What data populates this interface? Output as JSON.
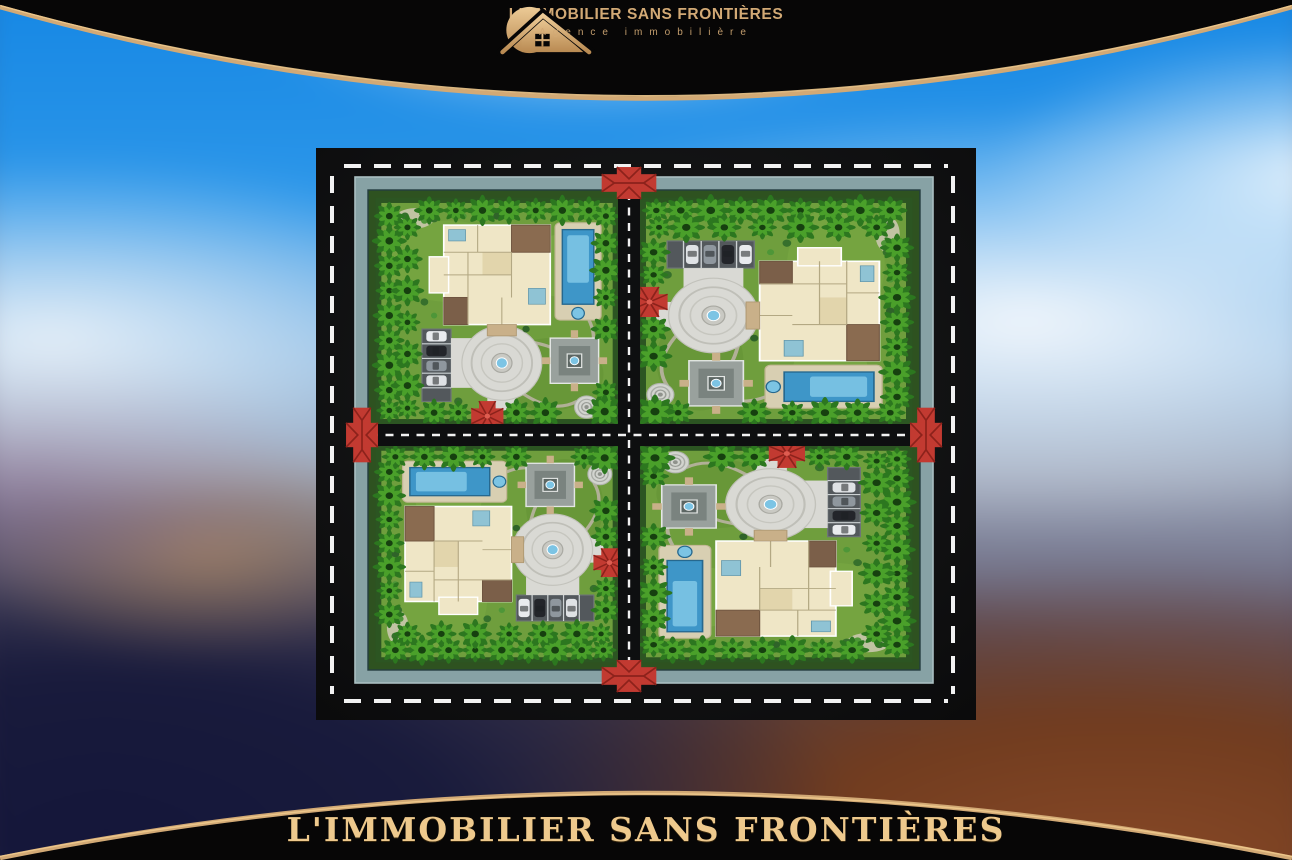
{
  "header": {
    "logo_icon": "sun-house-logo-icon",
    "brand": "L'IMMOBILIER SANS FRONTIÈRES",
    "tagline": "Agence immobilière"
  },
  "footer": {
    "title": "L'IMMOBILIER SANS FRONTIÈRES"
  },
  "theme": {
    "gold": "#d2a975",
    "gold_bright": "#eec98d",
    "band": "#070606",
    "lawn": "#6f9e3d",
    "pool": "#3e96c8",
    "pool_light": "#7cc4e4",
    "plaza": "#d9d9d4",
    "wall": "#87a2a5",
    "hedge": "#2e5220",
    "asphalt": "#0e0f10",
    "road_dash": "#f2f2f2",
    "gazebo_red": "#c23a31"
  },
  "master_plan": {
    "description": "Walled compound of four luxury villa plots separated by a central cross road, ringed by a perimeter road with white lane dashes",
    "plots": [
      {
        "id": "villa-plot-top-left",
        "features": [
          "villa-building",
          "swimming-pool",
          "circular-fountain-plaza",
          "stepped-garden-pavilion",
          "parking-court-with-cars",
          "palm-garden",
          "red-roof-entrance-gazebo",
          "spiral-fountain"
        ]
      },
      {
        "id": "villa-plot-top-right",
        "features": [
          "villa-building",
          "swimming-pool",
          "circular-fountain-plaza",
          "stepped-garden-pavilion",
          "parking-court-with-cars",
          "palm-garden",
          "red-roof-entrance-gazebo",
          "spiral-fountain"
        ]
      },
      {
        "id": "villa-plot-bottom-left",
        "features": [
          "villa-building",
          "swimming-pool",
          "circular-fountain-plaza",
          "stepped-garden-pavilion",
          "parking-court-with-cars",
          "palm-garden",
          "red-roof-entrance-gazebo",
          "spiral-fountain"
        ]
      },
      {
        "id": "villa-plot-bottom-right",
        "features": [
          "villa-building",
          "swimming-pool",
          "circular-fountain-plaza",
          "stepped-garden-pavilion",
          "parking-court-with-cars",
          "palm-garden",
          "red-roof-entrance-gazebo",
          "spiral-fountain"
        ]
      }
    ],
    "gates": [
      "north-gate",
      "west-gate",
      "east-gate",
      "south-gate"
    ]
  }
}
